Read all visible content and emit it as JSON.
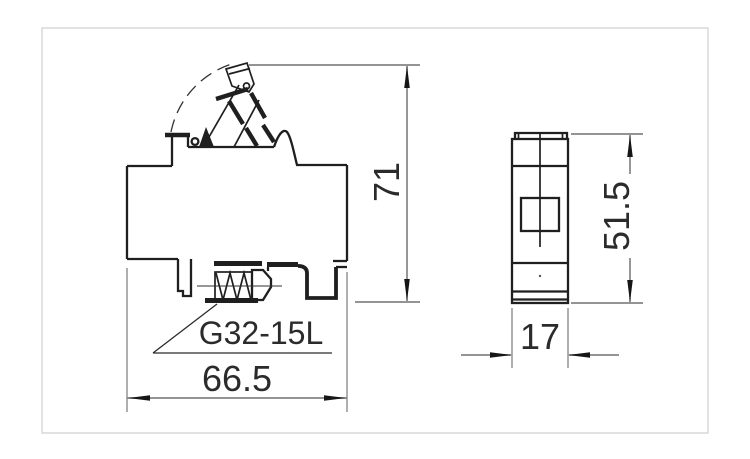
{
  "part_label": "G32-15L",
  "dims": {
    "side_height": "71",
    "side_width": "66.5",
    "front_height": "51.5",
    "front_width": "17"
  },
  "colors": {
    "outline": "#1f1f1f",
    "dimension_line": "#858585",
    "arrow": "#161616",
    "leader": "#2b2b2b",
    "text": "#2b2b2b",
    "frame": "#d9d9d9",
    "background": "#ffffff"
  }
}
